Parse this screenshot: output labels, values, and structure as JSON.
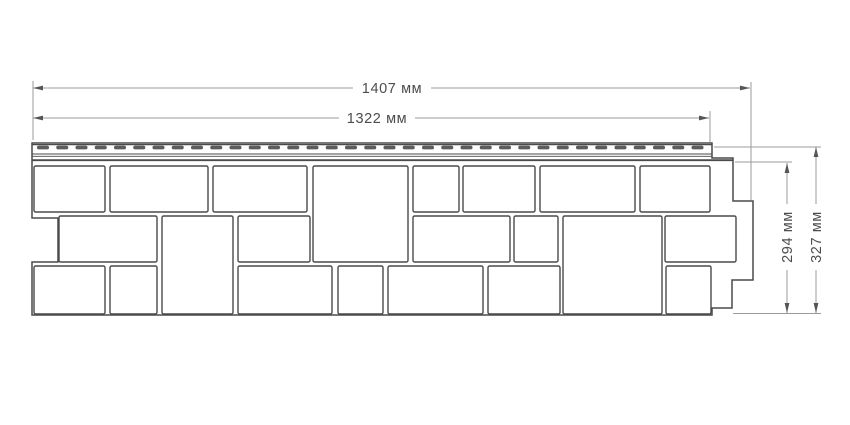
{
  "diagram": {
    "type": "technical-drawing",
    "subject": "facade-panel-with-stone-blocks",
    "units": "мм",
    "colors": {
      "outline": "#4a4a4a",
      "dimension_line": "#9b9b9b",
      "arrow": "#555555",
      "slot": "#5c5c5c",
      "text": "#4d4d4d",
      "background": "#ffffff"
    },
    "dimensions": {
      "total_width": {
        "value": 1407,
        "label": "1407 мм"
      },
      "useful_width": {
        "value": 1322,
        "label": "1322 мм"
      },
      "useful_height": {
        "value": 294,
        "label": "294 мм"
      },
      "total_height": {
        "value": 327,
        "label": "327 мм"
      }
    },
    "panel": {
      "outline_path": "M 32,143 H 712 V 158 H 733 V 201 H 753 V 280 H 732 V 308 H 712 V 315 H 32 V 262 H 58 V 218 H 32 Z",
      "nail_strip": {
        "slot_count": 35,
        "slot_start_x": 37,
        "slot_pitch": 19.25,
        "slot_width": 12,
        "slot_height": 3.8,
        "slot_y": 145.6
      },
      "blocks": [
        [
          34,
          166,
          71,
          46
        ],
        [
          110,
          166,
          98,
          46
        ],
        [
          213,
          166,
          94,
          46
        ],
        [
          313,
          166,
          95,
          96
        ],
        [
          413,
          166,
          46,
          46
        ],
        [
          463,
          166,
          72,
          46
        ],
        [
          540,
          166,
          95,
          46
        ],
        [
          640,
          166,
          70,
          46
        ],
        [
          59,
          216,
          98,
          46
        ],
        [
          162,
          216,
          71,
          98
        ],
        [
          238,
          216,
          72,
          46
        ],
        [
          413,
          216,
          97,
          46
        ],
        [
          514,
          216,
          44,
          46
        ],
        [
          563,
          216,
          99,
          98
        ],
        [
          665,
          216,
          71,
          46
        ],
        [
          34,
          266,
          71,
          48
        ],
        [
          110,
          266,
          47,
          48
        ],
        [
          238,
          266,
          94,
          48
        ],
        [
          338,
          266,
          45,
          48
        ],
        [
          388,
          266,
          95,
          48
        ],
        [
          488,
          266,
          72,
          48
        ],
        [
          666,
          266,
          45,
          48
        ]
      ]
    }
  }
}
